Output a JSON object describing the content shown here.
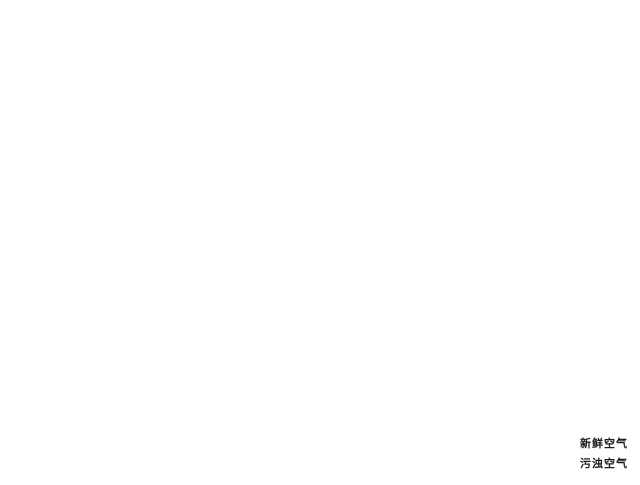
{
  "legend": {
    "items": [
      {
        "id": "fresh-air",
        "label": "新鲜空气",
        "color": "#4FA8DE"
      },
      {
        "id": "stale-air",
        "label": "污浊空气",
        "color": "#E23C8E"
      }
    ]
  },
  "system": {
    "colors": {
      "fresh": "#4FA8DE",
      "exhaust": "#E23C8E"
    },
    "unit": {
      "id": "ventilation-unit",
      "x": 196,
      "y": 186
    },
    "vents": [
      {
        "id": "wall-intake-exhaust-vent",
        "kind": "panel",
        "x": 134,
        "y": 139,
        "ring": "#DD4527"
      },
      {
        "id": "bathroom-exhaust-vent",
        "kind": "floor",
        "x": 317,
        "y": 137,
        "ring": "#DD4527"
      },
      {
        "id": "hallway-exhaust-vent",
        "kind": "floor",
        "x": 288,
        "y": 251,
        "ring": "#DD4527"
      },
      {
        "id": "bedroom1-supply-vent",
        "kind": "wall",
        "x": 449,
        "y": 87,
        "ring": "#DD4527"
      },
      {
        "id": "bedroom2-supply-vent",
        "kind": "wall",
        "x": 482,
        "y": 103,
        "ring": "#DD4527"
      },
      {
        "id": "master-bedroom-exhaust-vent",
        "kind": "floor",
        "x": 464,
        "y": 262,
        "ring": "#E2662C"
      },
      {
        "id": "living-room-supply-vent",
        "kind": "floor",
        "x": 277,
        "y": 413,
        "ring": "#DD4527"
      }
    ],
    "ducts": [
      {
        "id": "fresh-intake-duct",
        "system": "fresh",
        "pts": [
          [
            138,
            148
          ],
          [
            181,
            185
          ]
        ]
      },
      {
        "id": "fresh-trunk-duct",
        "system": "fresh",
        "pts": [
          [
            192,
            204
          ],
          [
            352,
            341
          ]
        ]
      },
      {
        "id": "fresh-living-branch",
        "system": "fresh",
        "pts": [
          [
            352,
            341
          ],
          [
            279,
            409
          ]
        ]
      },
      {
        "id": "fresh-bedroom1-branch",
        "system": "fresh",
        "pts": [
          [
            221,
            231
          ],
          [
            446,
            91
          ]
        ]
      },
      {
        "id": "fresh-bedroom2-branch",
        "system": "fresh",
        "pts": [
          [
            236,
            251
          ],
          [
            479,
            105
          ]
        ]
      },
      {
        "id": "exhaust-outlet-duct",
        "system": "exhaust",
        "pts": [
          [
            190,
            178
          ],
          [
            147,
            141
          ]
        ]
      },
      {
        "id": "exhaust-bathroom-branch",
        "system": "exhaust",
        "pts": [
          [
            315,
            141
          ],
          [
            202,
            192
          ]
        ]
      },
      {
        "id": "exhaust-trunk-duct",
        "system": "exhaust",
        "pts": [
          [
            357,
            333
          ],
          [
            208,
            202
          ]
        ]
      },
      {
        "id": "exhaust-master-branch",
        "system": "exhaust",
        "pts": [
          [
            460,
            265
          ],
          [
            357,
            333
          ]
        ]
      },
      {
        "id": "exhaust-hallway-branch",
        "system": "exhaust",
        "pts": [
          [
            357,
            333
          ],
          [
            291,
            253
          ]
        ]
      }
    ],
    "flow_arrows": [
      {
        "id": "stairs-flow",
        "color": "exhaust",
        "x": 88,
        "y": 278,
        "rot": -25,
        "type": "straight"
      },
      {
        "id": "bathroom-flow",
        "color": "exhaust",
        "x": 322,
        "y": 152,
        "rot": -90,
        "type": "straight"
      },
      {
        "id": "master-flow-up",
        "color": "exhaust",
        "x": 466,
        "y": 280,
        "rot": -90,
        "type": "straight"
      },
      {
        "id": "master-curl-left",
        "color": "exhaust",
        "x": 430,
        "y": 251,
        "rot": 140,
        "type": "curl"
      },
      {
        "id": "master-curl-right",
        "color": "exhaust",
        "x": 500,
        "y": 243,
        "rot": -140,
        "type": "curl"
      },
      {
        "id": "hallway-curl",
        "color": "exhaust",
        "x": 232,
        "y": 253,
        "rot": 170,
        "type": "curl"
      },
      {
        "id": "bedroom1-supply-flow",
        "color": "fresh",
        "x": 436,
        "y": 85,
        "rot": 180,
        "type": "straight"
      },
      {
        "id": "master-supply-down",
        "color": "fresh",
        "x": 440,
        "y": 243,
        "rot": 100,
        "type": "curl"
      },
      {
        "id": "master-supply-small",
        "color": "fresh",
        "x": 475,
        "y": 255,
        "rot": 70,
        "type": "curl"
      },
      {
        "id": "master-lamp-curl",
        "color": "fresh",
        "x": 531,
        "y": 170,
        "rot": 115,
        "type": "curl"
      },
      {
        "id": "living-flow-up",
        "color": "fresh",
        "x": 247,
        "y": 392,
        "rot": -80,
        "type": "straight"
      },
      {
        "id": "living-curl-1",
        "color": "fresh",
        "x": 233,
        "y": 424,
        "rot": -155,
        "type": "curl"
      },
      {
        "id": "living-curl-2",
        "color": "fresh",
        "x": 265,
        "y": 420,
        "rot": -120,
        "type": "curl"
      }
    ]
  }
}
